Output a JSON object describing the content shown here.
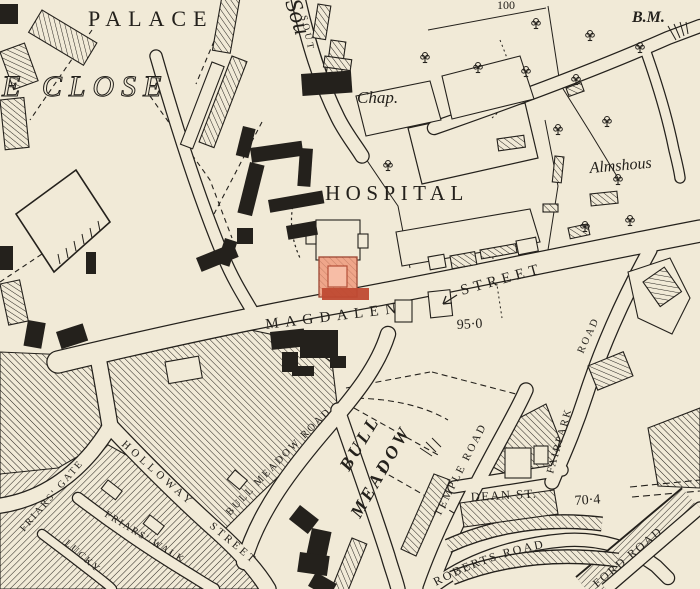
{
  "map": {
    "description": "Historic town map with highlighted building on Magdalen Street",
    "colors": {
      "paper": "#f1ead7",
      "ink": "#24211c",
      "highlight_fill": "#ef9678",
      "highlight_inner": "#f7bda6",
      "highlight_dark": "#bf4a33"
    },
    "labels": {
      "palace": "PALACE",
      "close": "E CLOSE",
      "south_big": "Sou",
      "south_small": "SOUT",
      "chapel": "Chap.",
      "hospital": "HOSPITAL",
      "benchmark": "B.M.",
      "contour": "100",
      "almshouses": "Almshous",
      "magdalen": "MAGDALEN",
      "magdalen_street2": "STREET",
      "spot_95": "95·0",
      "spot_70": "70·4",
      "fairpark_a": "FAIRPARK",
      "fairpark_b": "ROAD",
      "temple_road": "TEMPLE ROAD",
      "dean_st": "DEAN ST.",
      "roberts_road": "ROBERTS ROAD",
      "ford_road": "FORD ROAD",
      "bull_meadow_road": "BULL MEADOW ROAD",
      "bull": "BULL",
      "meadow": "MEADOW",
      "holloway": "HOLLOWAY",
      "holloway_street2": "STREET",
      "friars_gate": "FRIARS' GATE",
      "friars_walk": "FRIARS' WALK",
      "lucky": "LUCKY"
    }
  }
}
